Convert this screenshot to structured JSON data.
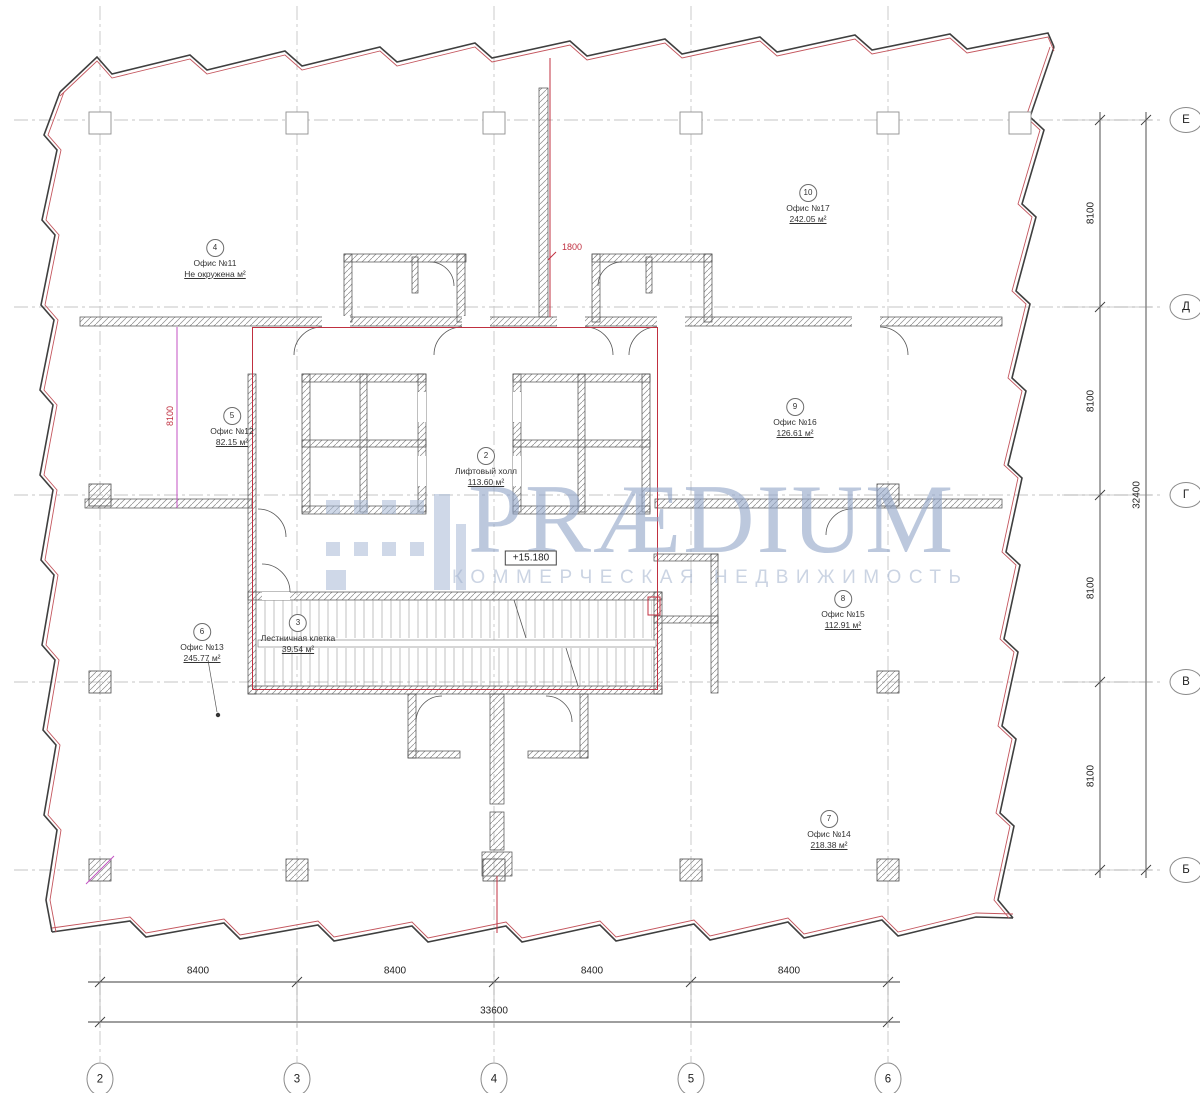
{
  "watermark": {
    "name": "PRÆDIUM",
    "subtitle": "КОММЕРЧЕСКАЯ НЕДВИЖИМОСТЬ"
  },
  "level_mark": "+15.180",
  "rooms": [
    {
      "num": "4",
      "name": "Офис №11",
      "area": "Не окружена м²"
    },
    {
      "num": "10",
      "name": "Офис №17",
      "area": "242.05 м²"
    },
    {
      "num": "5",
      "name": "Офис №12",
      "area": "82.15 м²"
    },
    {
      "num": "2",
      "name": "Лифтовый холл",
      "area": "113.60 м²"
    },
    {
      "num": "9",
      "name": "Офис №16",
      "area": "126.61 м²"
    },
    {
      "num": "8",
      "name": "Офис №15",
      "area": "112.91 м²"
    },
    {
      "num": "6",
      "name": "Офис №13",
      "area": "245.77 м²"
    },
    {
      "num": "7",
      "name": "Офис №14",
      "area": "218.38 м²"
    },
    {
      "num": "3",
      "name": "Лестничная клетка",
      "area": "39.54 м²"
    }
  ],
  "red_dimensions": {
    "top": "1800",
    "left": "8100"
  },
  "dimensions": {
    "bottom": {
      "segments": [
        "8400",
        "8400",
        "8400",
        "8400"
      ],
      "total": "33600"
    },
    "right": {
      "segments": [
        "8100",
        "8100",
        "8100",
        "8100"
      ],
      "total": "32400"
    }
  },
  "axes": {
    "bottom": [
      "2",
      "3",
      "4",
      "5",
      "6"
    ],
    "right": [
      "Е",
      "Д",
      "Г",
      "В",
      "Б"
    ]
  }
}
